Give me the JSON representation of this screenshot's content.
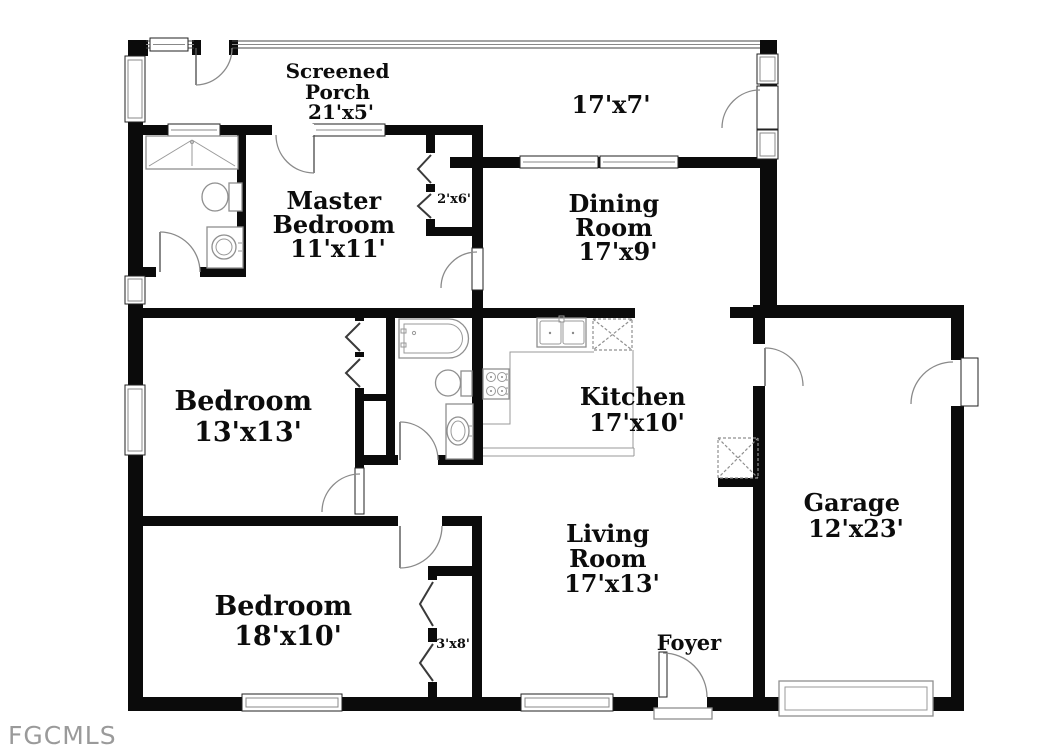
{
  "watermark": "FGCMLS",
  "colors": {
    "wall": "#0b0b0b",
    "fixture_line": "#8f8f8f",
    "door_arc": "#8a8a8a",
    "label_text": "#0c0c0c",
    "watermark_text": "#9a9a9a",
    "background": "#ffffff"
  },
  "plan": {
    "type": "single-story residential floor plan",
    "rooms": [
      {
        "name": "screened-porch",
        "size": "21'x5'",
        "label_lines": [
          "Screened",
          "Porch",
          "21'x5'"
        ]
      },
      {
        "name": "screened-porch-right",
        "size": "17'x7'",
        "label_lines": [
          "17'x7'"
        ]
      },
      {
        "name": "master-bedroom",
        "size": "11'x11'",
        "label_lines": [
          "Master",
          "Bedroom",
          "11'x11'"
        ]
      },
      {
        "name": "master-closet",
        "size": "2'x6'",
        "label_lines": [
          "2'x6'"
        ]
      },
      {
        "name": "dining-room",
        "size": "17'x9'",
        "label_lines": [
          "Dining",
          "Room",
          "17'x9'"
        ]
      },
      {
        "name": "bedroom-2",
        "size": "13'x13'",
        "label_lines": [
          "Bedroom",
          "13'x13'"
        ]
      },
      {
        "name": "kitchen",
        "size": "17'x10'",
        "label_lines": [
          "Kitchen",
          "17'x10'"
        ]
      },
      {
        "name": "garage",
        "size": "12'x23'",
        "label_lines": [
          "Garage",
          "12'x23'"
        ]
      },
      {
        "name": "bedroom-3",
        "size": "18'x10'",
        "label_lines": [
          "Bedroom",
          "18'x10'"
        ]
      },
      {
        "name": "living-room",
        "size": "17'x13'",
        "label_lines": [
          "Living",
          "Room",
          "17'x13'"
        ]
      },
      {
        "name": "foyer",
        "size": "",
        "label_lines": [
          "Foyer"
        ]
      },
      {
        "name": "hall-closet",
        "size": "3'x8'",
        "label_lines": [
          "3'x8'"
        ]
      }
    ]
  }
}
